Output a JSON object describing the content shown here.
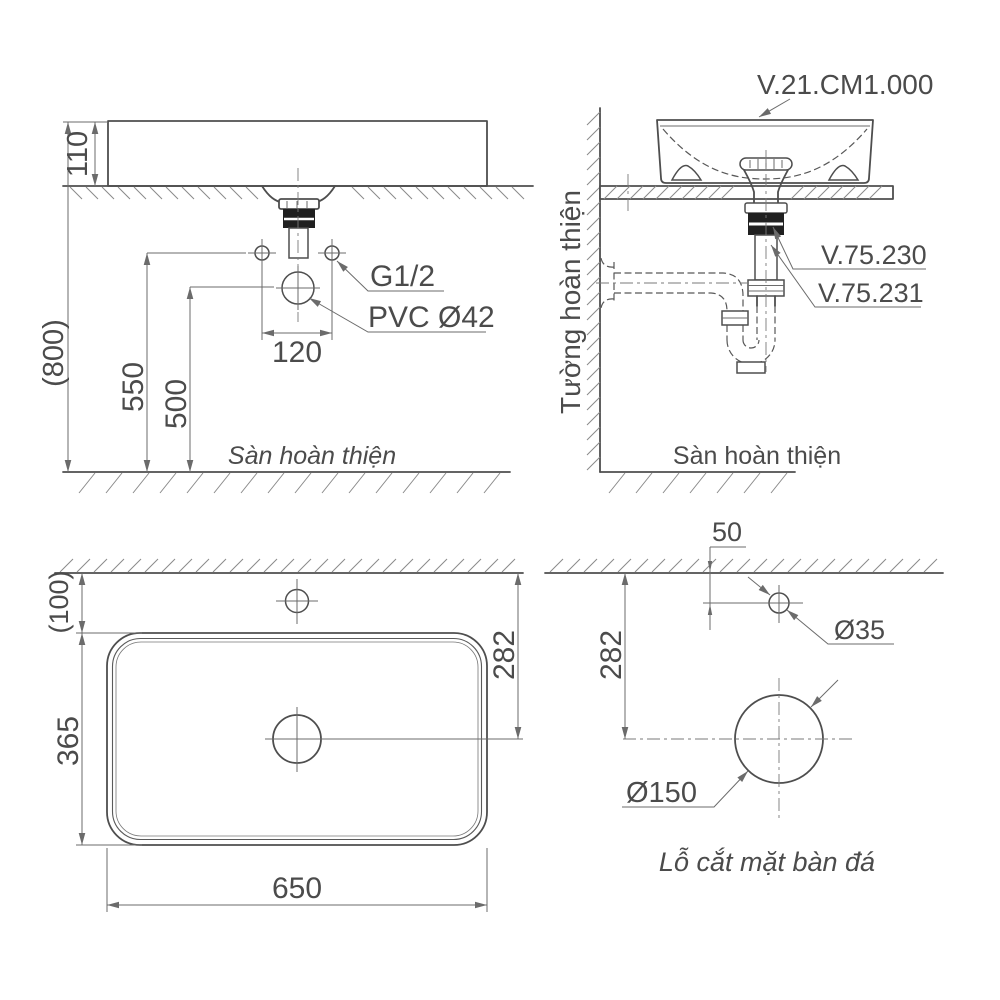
{
  "front_view": {
    "dim_overall_height": "(800)",
    "dim_basin_height": "110",
    "dim_supply_height": "550",
    "dim_pvc_height": "500",
    "dim_supply_spacing": "120",
    "label_supply_thread": "G1/2",
    "label_pvc_drain": "PVC Ø42",
    "label_floor": "Sàn hoàn thiện"
  },
  "side_view": {
    "label_product_code": "V.21.CM1.000",
    "label_drain_code": "V.75.230",
    "label_trap_code": "V.75.231",
    "label_wall": "Tường hoàn thiện",
    "label_floor": "Sàn hoàn thiện"
  },
  "plan_view": {
    "dim_wall_clearance": "(100)",
    "dim_basin_depth": "365",
    "dim_basin_width": "650",
    "dim_drain_distance": "282"
  },
  "cutout_view": {
    "dim_faucet_hole_offset": "50",
    "dim_drain_hole_distance": "282",
    "label_faucet_hole_dia": "Ø35",
    "label_drain_hole_dia": "Ø150",
    "caption": "Lỗ cắt mặt bàn đá"
  },
  "colors": {
    "line": "#4e4e4e",
    "dimension": "#6b6b6b",
    "fitting_black": "#202020",
    "background": "#ffffff"
  }
}
